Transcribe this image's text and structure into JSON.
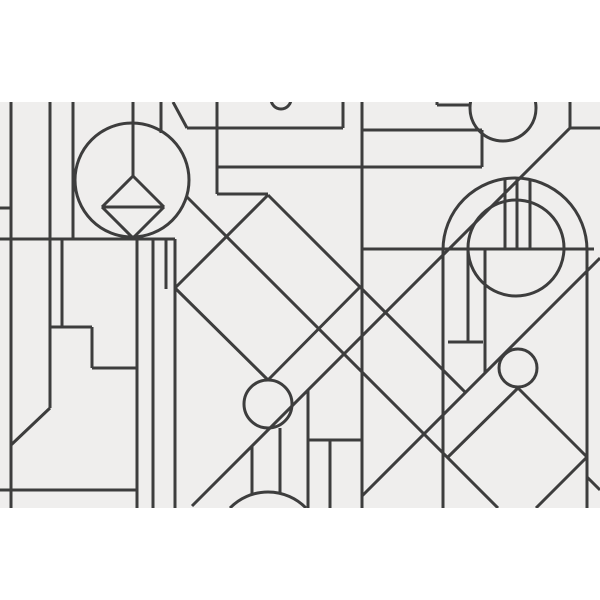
{
  "artwork": {
    "title": "art-deco-geometric-line-pattern",
    "canvas": {
      "width": 600,
      "height": 600
    },
    "field": {
      "x": 0,
      "y": 102,
      "width": 600,
      "height": 406
    },
    "colors": {
      "page_background": "#ffffff",
      "field_background": "#efeeed",
      "line": "#3d3d3d"
    },
    "line_width": 3,
    "lines": [
      {
        "name": "left-edge-vertical",
        "p": [
          11,
          102,
          11,
          508
        ]
      },
      {
        "name": "left-tall-vertical",
        "p": [
          50,
          102,
          50,
          408
        ]
      },
      {
        "name": "left-short-vertical",
        "p": [
          73,
          102,
          73,
          239
        ]
      },
      {
        "name": "circle-stem-vertical",
        "p": [
          133,
          102,
          133,
          176
        ]
      },
      {
        "name": "circle-right-stem",
        "p": [
          161,
          102,
          161,
          133
        ]
      },
      {
        "name": "band-left-vertical",
        "p": [
          217,
          102,
          217,
          194
        ]
      },
      {
        "name": "band-top-vertical",
        "p": [
          343,
          102,
          343,
          128
        ]
      },
      {
        "name": "center-tall-vertical",
        "p": [
          362,
          102,
          362,
          508
        ]
      },
      {
        "name": "topright-corner-vertical",
        "p": [
          570,
          102,
          570,
          128
        ]
      },
      {
        "name": "step-upper-vertical",
        "p": [
          62,
          239,
          62,
          327
        ]
      },
      {
        "name": "step-lower-vertical",
        "p": [
          92,
          327,
          92,
          368
        ]
      },
      {
        "name": "column-vertical-1",
        "p": [
          137,
          239,
          137,
          508
        ]
      },
      {
        "name": "column-vertical-2",
        "p": [
          153,
          239,
          153,
          508
        ]
      },
      {
        "name": "column-vertical-3",
        "p": [
          166,
          239,
          166,
          289
        ]
      },
      {
        "name": "column-vertical-4",
        "p": [
          175,
          239,
          175,
          508
        ]
      },
      {
        "name": "sun-ray-vertical-1",
        "p": [
          252,
          446,
          252,
          494
        ]
      },
      {
        "name": "sun-ray-vertical-2",
        "p": [
          280,
          428,
          280,
          493
        ]
      },
      {
        "name": "sun-ray-vertical-3",
        "p": [
          308,
          390,
          308,
          508
        ]
      },
      {
        "name": "bottom-box-vertical",
        "p": [
          330,
          440,
          330,
          508
        ]
      },
      {
        "name": "arch-left-side",
        "p": [
          443,
          250,
          443,
          508
        ]
      },
      {
        "name": "arch-right-side",
        "p": [
          587,
          250,
          587,
          508
        ]
      },
      {
        "name": "arch-inner-vertical-1",
        "p": [
          468,
          249,
          468,
          342
        ]
      },
      {
        "name": "arch-inner-vertical-2",
        "p": [
          485,
          249,
          485,
          373
        ]
      },
      {
        "name": "arch-spoke-1",
        "p": [
          505,
          179,
          505,
          249
        ]
      },
      {
        "name": "arch-spoke-2",
        "p": [
          517,
          178,
          517,
          249
        ]
      },
      {
        "name": "arch-spoke-3",
        "p": [
          530,
          180,
          530,
          249
        ]
      },
      {
        "name": "topright-tick-vertical",
        "p": [
          437,
          102,
          437,
          105
        ]
      },
      {
        "name": "band-right-vertical",
        "p": [
          482,
          130,
          482,
          167
        ]
      },
      {
        "name": "band-top-horizontal-left",
        "p": [
          187,
          128,
          343,
          128
        ]
      },
      {
        "name": "band-top-horizontal-right",
        "p": [
          362,
          130,
          482,
          130
        ]
      },
      {
        "name": "band-bottom-horizontal",
        "p": [
          217,
          167,
          482,
          167
        ]
      },
      {
        "name": "apex-horizontal",
        "p": [
          217,
          194,
          268,
          194
        ]
      },
      {
        "name": "left-tick-horizontal",
        "p": [
          0,
          208,
          11,
          208
        ]
      },
      {
        "name": "left-long-horizontal",
        "p": [
          0,
          239,
          175,
          239
        ]
      },
      {
        "name": "arch-diameter-horizontal",
        "p": [
          362,
          249,
          594,
          249
        ]
      },
      {
        "name": "arch-inner-tick",
        "p": [
          448,
          342,
          483,
          342
        ]
      },
      {
        "name": "step-horizontal-upper",
        "p": [
          50,
          327,
          92,
          327
        ]
      },
      {
        "name": "step-horizontal-lower",
        "p": [
          92,
          368,
          137,
          368
        ]
      },
      {
        "name": "bottom-box-horizontal",
        "p": [
          308,
          440,
          362,
          440
        ]
      },
      {
        "name": "bottom-left-horizontal",
        "p": [
          0,
          490,
          137,
          490
        ]
      },
      {
        "name": "topright-tick-horizontal",
        "p": [
          437,
          105,
          470,
          105
        ]
      },
      {
        "name": "topright-edge-horizontal",
        "p": [
          570,
          128,
          600,
          128
        ]
      },
      {
        "name": "topleft-corner-diagonal",
        "p": [
          173,
          102,
          187,
          128
        ]
      },
      {
        "name": "long-diagonal-main",
        "p": [
          192,
          506,
          570,
          128
        ]
      },
      {
        "name": "long-diagonal-lower",
        "p": [
          362,
          496,
          600,
          258
        ]
      },
      {
        "name": "long-diagonal-cross",
        "p": [
          186,
          196,
          498,
          508
        ]
      },
      {
        "name": "diamond-edge-extended",
        "p": [
          268,
          195,
          465,
          392
        ]
      },
      {
        "name": "bottom-left-diagonal",
        "p": [
          50,
          408,
          11,
          445
        ]
      },
      {
        "name": "bottom-right-corner-diagonal",
        "p": [
          587,
          477,
          600,
          490
        ]
      },
      {
        "name": "right-diamond-upper-left",
        "p": [
          448,
          457,
          518,
          388
        ]
      },
      {
        "name": "right-diamond-upper-right",
        "p": [
          518,
          388,
          587,
          457
        ]
      },
      {
        "name": "right-diamond-lower-right",
        "p": [
          587,
          457,
          536,
          508
        ]
      },
      {
        "name": "center-diamond-lower-right",
        "p": [
          360,
          287,
          268,
          380
        ]
      },
      {
        "name": "center-diamond-lower-left",
        "p": [
          268,
          380,
          175,
          288
        ]
      },
      {
        "name": "center-diamond-upper-left",
        "p": [
          175,
          288,
          268,
          195
        ]
      },
      {
        "name": "left-diamond-upper-right",
        "p": [
          133,
          176,
          164,
          207
        ]
      },
      {
        "name": "left-diamond-lower-right",
        "p": [
          164,
          207,
          133,
          238
        ]
      },
      {
        "name": "left-diamond-lower-left",
        "p": [
          133,
          238,
          102,
          207
        ]
      },
      {
        "name": "left-diamond-upper-left",
        "p": [
          102,
          207,
          133,
          176
        ]
      },
      {
        "name": "left-diamond-midline",
        "p": [
          102,
          207,
          164,
          207
        ]
      }
    ],
    "circles": [
      {
        "name": "topleft-circle",
        "cx": 132,
        "cy": 180,
        "r": 57
      },
      {
        "name": "center-diamond-circle",
        "cx": 268,
        "cy": 404,
        "r": 24
      },
      {
        "name": "top-edge-small-circle",
        "cx": 281,
        "cy": 99,
        "r": 10
      },
      {
        "name": "topright-clipped-circle",
        "cx": 503,
        "cy": 108,
        "r": 33
      },
      {
        "name": "arch-inner-circle",
        "cx": 516,
        "cy": 248,
        "r": 48
      },
      {
        "name": "right-small-circle",
        "cx": 518,
        "cy": 368,
        "r": 19
      }
    ],
    "arcs": [
      {
        "name": "arch-outer-arc",
        "d": "M 443 250 A 72 72 0 0 1 587 250"
      },
      {
        "name": "bottom-sun-arc",
        "d": "M 230 508 A 53 53 0 0 1 306 508"
      }
    ]
  }
}
